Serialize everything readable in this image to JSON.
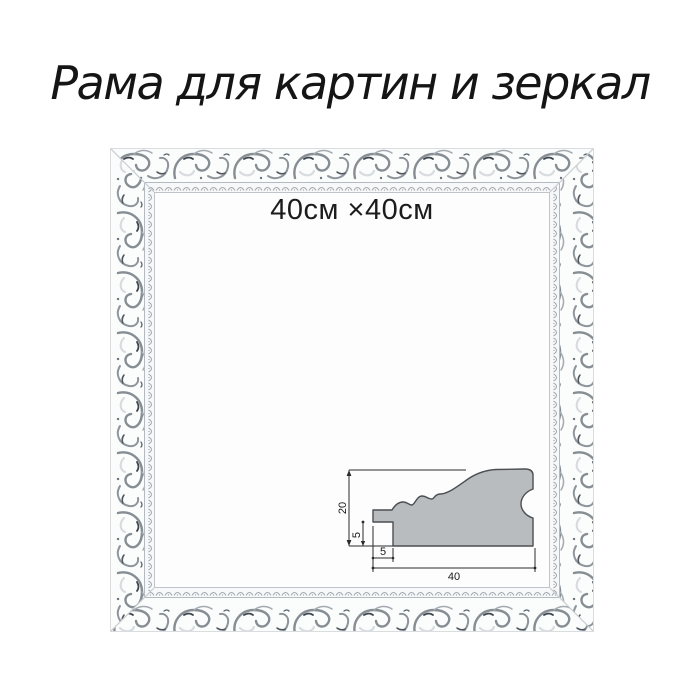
{
  "title": "Рама для картин и зеркал",
  "frame": {
    "size_label": "40см ×40см",
    "ornament_style": "baroque-scroll-distressed",
    "colors": {
      "base_white": "#fbfcfc",
      "ornament_silver": "#868e94",
      "ornament_dark": "#3e454c",
      "lip_bead": "#a0a7ad",
      "groove": "#b3bac0",
      "outer_edge": "#d9dde0"
    }
  },
  "profile_diagram": {
    "dims": {
      "height": "20",
      "rabbet_depth": "5",
      "lip_width": "5",
      "total_width": "40"
    },
    "fill_color": "#b9bcbe",
    "line_color": "#2b2b2b"
  }
}
